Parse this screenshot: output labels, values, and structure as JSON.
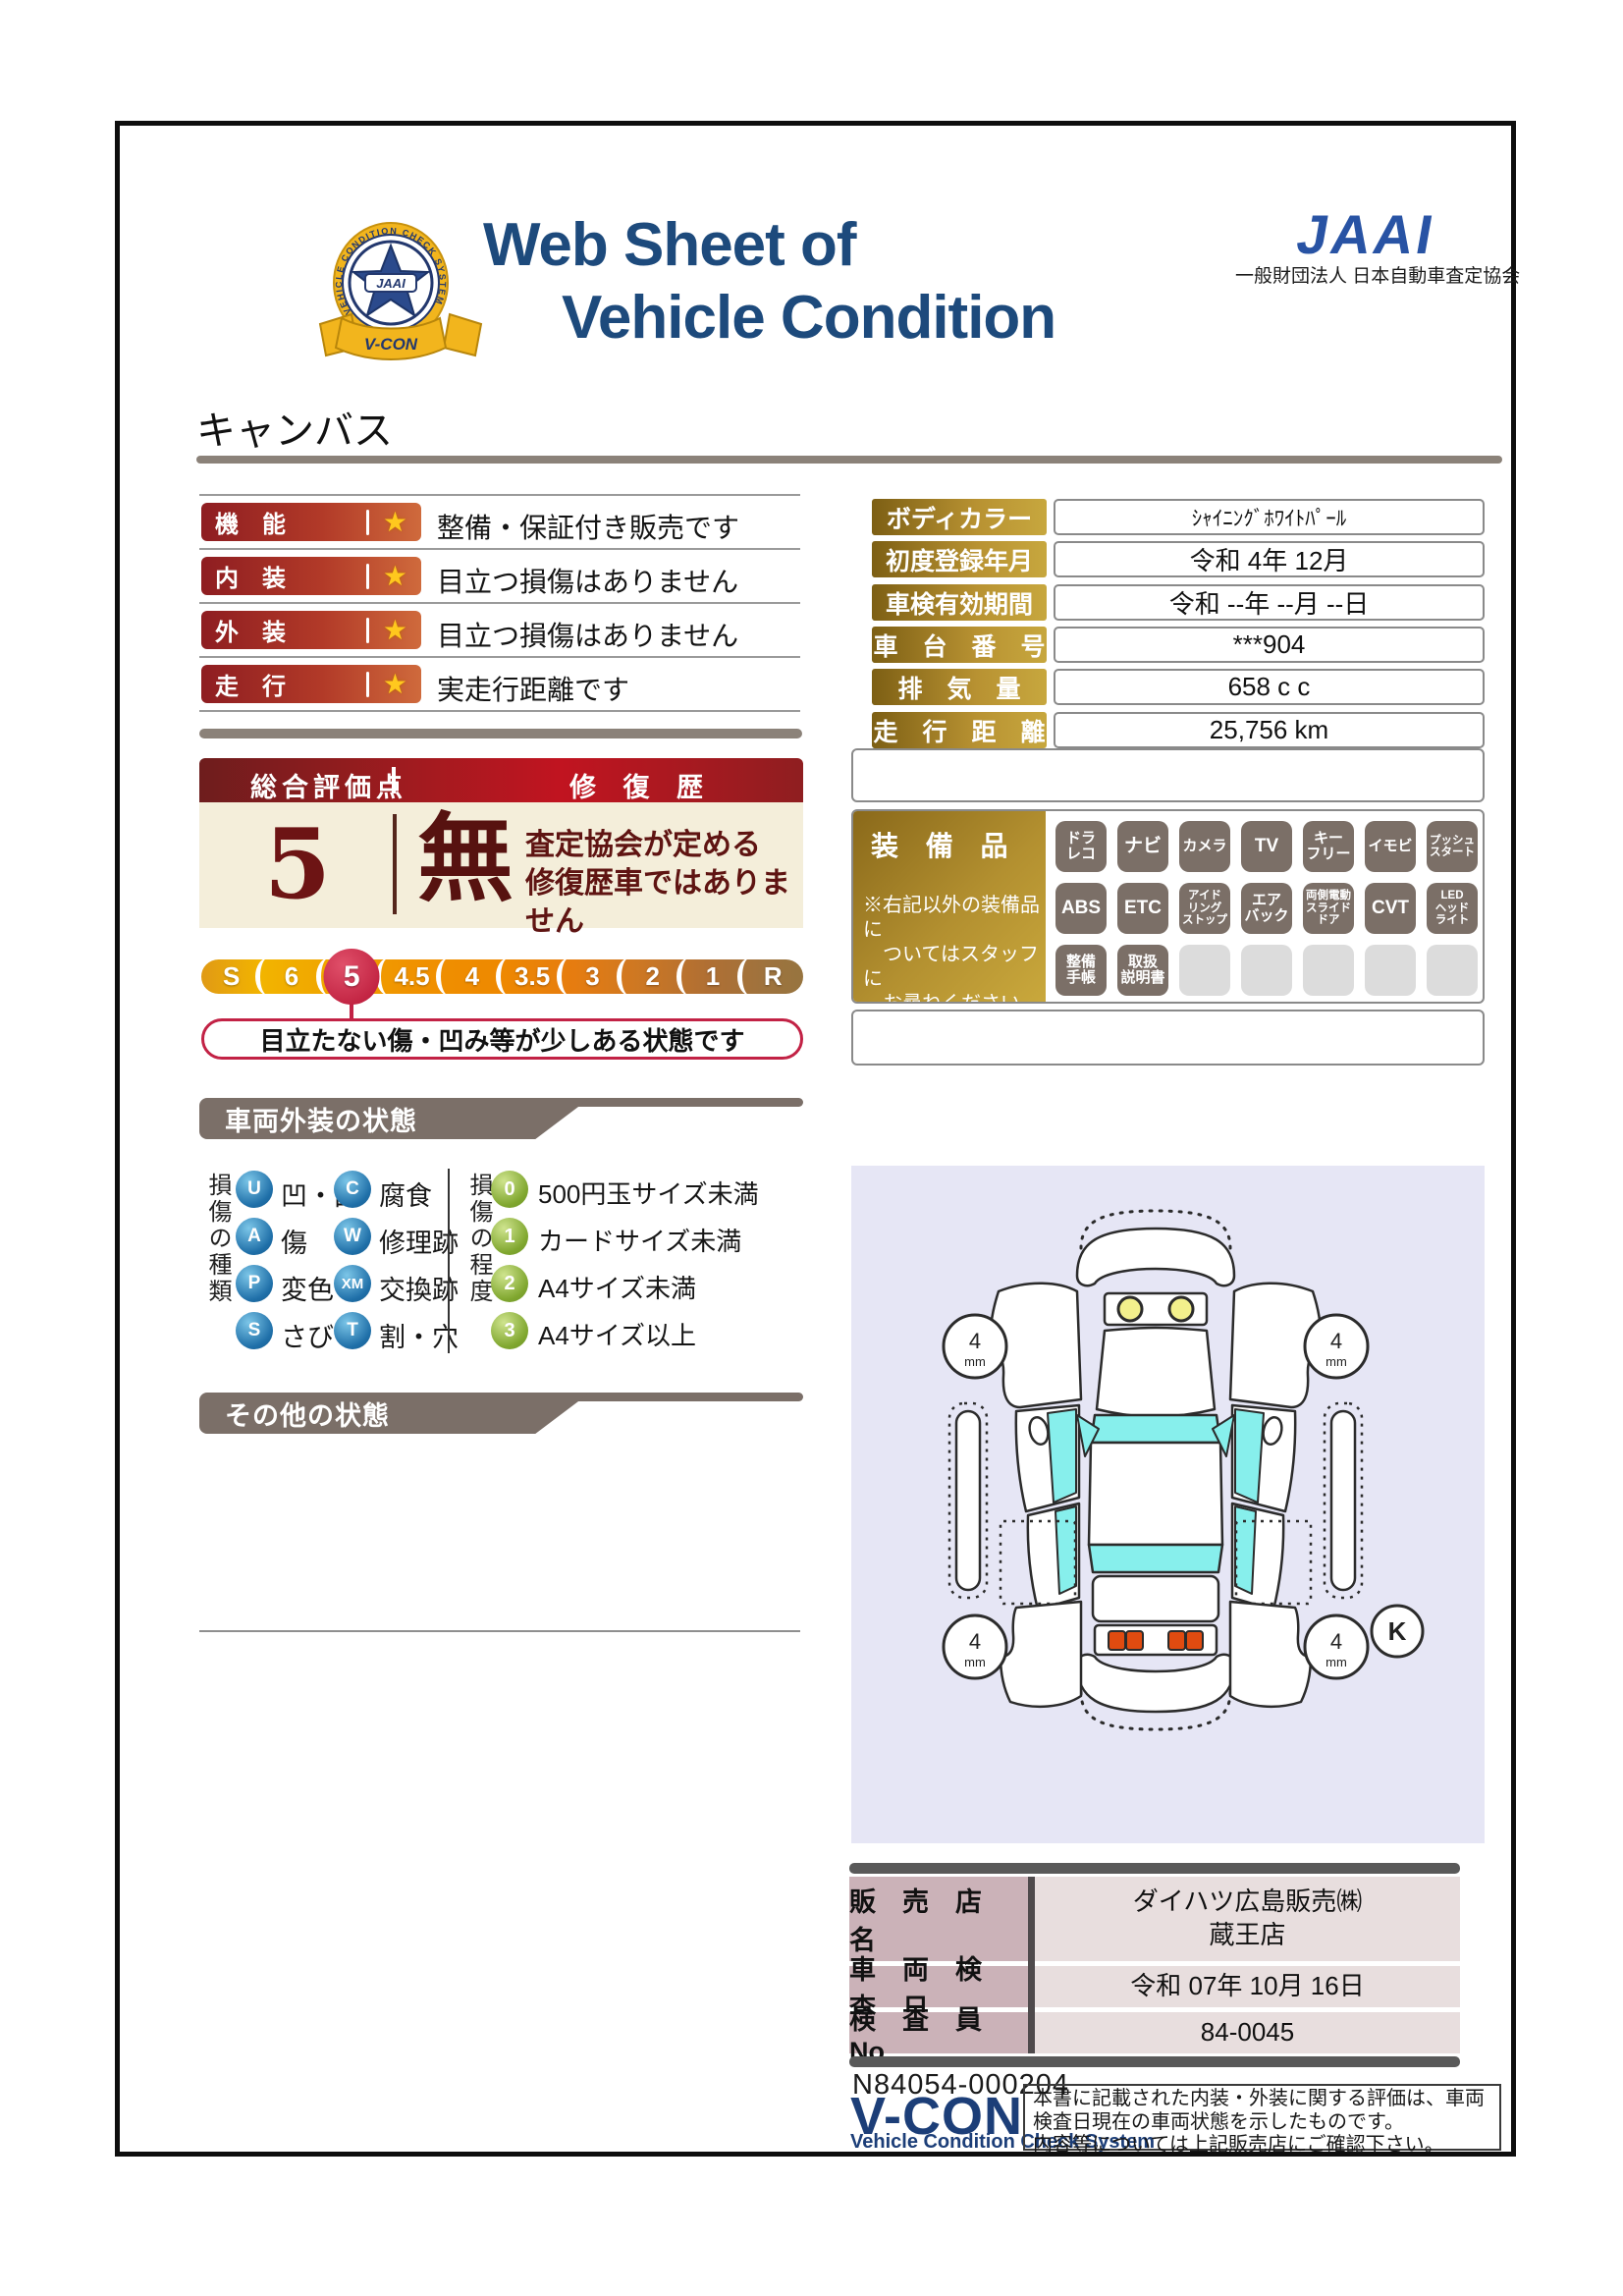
{
  "header": {
    "title_line1": "Web Sheet of",
    "title_line2": "Vehicle Condition",
    "emblem": {
      "ring_text": "VEHICLE CONDITION CHECK SYSTEM",
      "center_text": "JAAI",
      "ribbon_text": "V-CON"
    },
    "org_logo_text": "JAAI",
    "org_name": "一般財団法人 日本自動車査定協会"
  },
  "vehicle_name": "キャンバス",
  "ratings": {
    "star": "★",
    "rows": [
      {
        "label": "機　能",
        "comment": "整備・保証付き販売です"
      },
      {
        "label": "内　装",
        "comment": "目立つ損傷はありません"
      },
      {
        "label": "外　装",
        "comment": "目立つ損傷はありません"
      },
      {
        "label": "走　行",
        "comment": "実走行距離です"
      }
    ]
  },
  "overall": {
    "score_title": "総合評価点",
    "repair_title": "修 復 歴",
    "score": "5",
    "repair_value": "無",
    "repair_note": "査定協会が定める\n修復歴車ではありません",
    "scale_labels": [
      "S",
      "6",
      "5",
      "4.5",
      "4",
      "3.5",
      "3",
      "2",
      "1",
      "R"
    ],
    "selected_label": "5",
    "callout": "目立たない傷・凹み等が少しある状態です"
  },
  "details": {
    "rows": [
      {
        "label": "ボディカラー",
        "value": "ｼｬｲﾆﾝｸﾞﾎﾜｲﾄﾊﾟｰﾙ"
      },
      {
        "label": "初度登録年月",
        "value": "令和 4年 12月"
      },
      {
        "label": "車検有効期間",
        "value": "令和 --年 --月 --日"
      },
      {
        "label": "車　台　番　号",
        "value": "***904"
      },
      {
        "label": "排　気　量",
        "value": "658 c c"
      },
      {
        "label": "走　行　距　離",
        "value": "25,756 km"
      }
    ]
  },
  "equipment": {
    "title": "装 備 品",
    "note": "※右記以外の装備品に\n　ついてはスタッフに\n　お尋ねください。",
    "badges": [
      [
        "ドラ\nレコ",
        "ナビ",
        "カメラ",
        "TV",
        "キー\nフリー",
        "イモビ",
        "プッシュ\nスタート"
      ],
      [
        "ABS",
        "ETC",
        "アイド\nリング\nストップ",
        "エア\nバック",
        "両側電動\nスライド\nドア",
        "CVT",
        "LED\nヘッド\nライト"
      ],
      [
        "整備\n手帳",
        "取扱\n説明書",
        "",
        "",
        "",
        "",
        ""
      ]
    ]
  },
  "exterior_section": {
    "title": "車両外装の状態",
    "type_legend": {
      "title": "損傷の種類",
      "items": [
        {
          "code": "U",
          "label": "凹・曲"
        },
        {
          "code": "C",
          "label": "腐食"
        },
        {
          "code": "A",
          "label": "傷"
        },
        {
          "code": "W",
          "label": "修理跡"
        },
        {
          "code": "P",
          "label": "変色"
        },
        {
          "code": "XM",
          "label": "交換跡"
        },
        {
          "code": "S",
          "label": "さび"
        },
        {
          "code": "T",
          "label": "割・穴"
        }
      ]
    },
    "level_legend": {
      "title": "損傷の程度",
      "items": [
        {
          "code": "0",
          "label": "500円玉サイズ未満"
        },
        {
          "code": "1",
          "label": "カードサイズ未満"
        },
        {
          "code": "2",
          "label": "A4サイズ未満"
        },
        {
          "code": "3",
          "label": "A4サイズ以上"
        }
      ]
    }
  },
  "other_section": {
    "title": "その他の状態"
  },
  "diagram": {
    "tire_value": "4",
    "tire_unit": "mm",
    "key_label": "K"
  },
  "dealer": {
    "rows": [
      {
        "label": "販　売　店　名",
        "value": "ダイハツ広島販売㈱\n蔵王店"
      },
      {
        "label": "車　両　検　査　日",
        "value": "令和 07年 10月 16日"
      },
      {
        "label": "検　査　員　No",
        "value": "84-0045"
      }
    ]
  },
  "footer": {
    "serial": "N84054-000204",
    "vcon": "V-CON",
    "vcon_sub": "Vehicle Condition Check System",
    "disclaimer": "本書に記載された内装・外装に関する評価は、車両\n検査日現在の車両状態を示したものです。\n内容等については上記販売店にご確認下さい。"
  }
}
